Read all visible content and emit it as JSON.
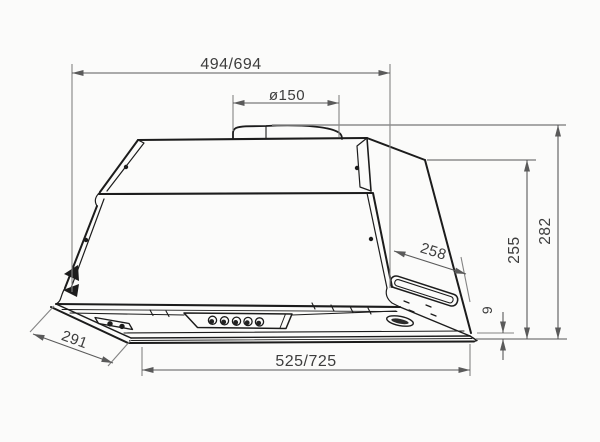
{
  "page": {
    "background": "#fbfbfa",
    "line_color": "#1c1c1c",
    "dimension_line_color": "#5a5a5a",
    "text_color": "#3d3d3d"
  },
  "drawing": {
    "dimensions": {
      "top_width": {
        "label": "494/694"
      },
      "duct_diameter": {
        "label": "ø150"
      },
      "side_depth": {
        "label": "258"
      },
      "body_height": {
        "label": "255"
      },
      "overall_height": {
        "label": "282"
      },
      "bottom_lip": {
        "label": "9"
      },
      "bottom_width": {
        "label": "525/725"
      },
      "bottom_depth": {
        "label": "291"
      }
    },
    "features": {
      "control_buttons_count": 5
    }
  }
}
